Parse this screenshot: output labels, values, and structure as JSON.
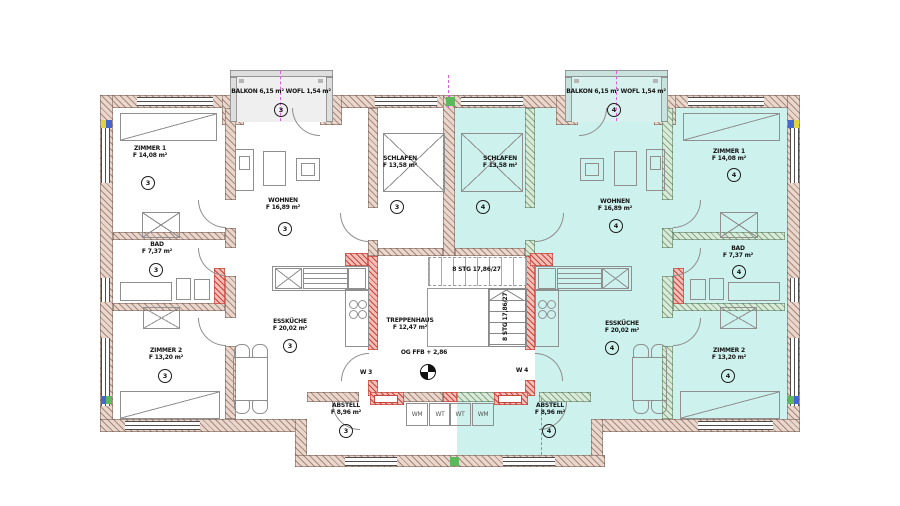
{
  "drawing": {
    "type": "floor-plan",
    "level_label": "OG FFB + 2,86",
    "stair_flight_label": "8 STG 17,86/27",
    "stairwell": {
      "name": "TREPPENHAUS",
      "area": "F 12,47 m²"
    },
    "apartment_left": {
      "number": "3",
      "door_label": "W 3",
      "balcony_label": "BALKON 6,15 m²  WOFL 1,54 m²",
      "rooms": {
        "zimmer1": {
          "name": "ZIMMER 1",
          "area": "F 14,08 m²"
        },
        "schlafen": {
          "name": "SCHLAFEN",
          "area": "F 13,58 m²"
        },
        "wohnen": {
          "name": "WOHNEN",
          "area": "F 16,89 m²"
        },
        "bad": {
          "name": "BAD",
          "area": "F 7,37 m²"
        },
        "zimmer2": {
          "name": "ZIMMER 2",
          "area": "F 13,20 m²"
        },
        "esskueche": {
          "name": "ESSKÜCHE",
          "area": "F 20,02 m²"
        },
        "abstell": {
          "name": "ABSTELL",
          "area": "F 8,96 m²"
        }
      },
      "appliances": [
        "WM",
        "WT"
      ]
    },
    "apartment_right": {
      "number": "4",
      "door_label": "W 4",
      "balcony_label": "BALKON 6,15 m²  WOFL 1,54 m²",
      "rooms": {
        "zimmer1": {
          "name": "ZIMMER 1",
          "area": "F 14,08 m²"
        },
        "schlafen": {
          "name": "SCHLAFEN",
          "area": "F 13,58 m²"
        },
        "wohnen": {
          "name": "WOHNEN",
          "area": "F 16,89 m²"
        },
        "bad": {
          "name": "BAD",
          "area": "F 7,37 m²"
        },
        "zimmer2": {
          "name": "ZIMMER 2",
          "area": "F 13,20 m²"
        },
        "esskueche": {
          "name": "ESSKÜCHE",
          "area": "F 20,02 m²"
        },
        "abstell": {
          "name": "ABSTELL",
          "area": "F 8,96 m²"
        }
      },
      "appliances": [
        "WT",
        "WM"
      ]
    },
    "colors": {
      "unit_fill": "#cdf1ed",
      "balcony_left_fill": "#efefef",
      "balcony_right_fill": "#d7f2ee",
      "balcony_left_wall": "#dedede",
      "balcony_right_wall": "#c9e2de",
      "wall_fill": "#e9d7cd",
      "wall_hatch": "#a8887a",
      "wall2_fill": "#d9ead9",
      "wall2_hatch": "#85a886",
      "new_fill": "#f6beb6",
      "new_hatch": "#c5473d",
      "axis": "#d863d8",
      "marker_yellow": "#ded53e",
      "marker_blue": "#4666cf",
      "marker_green": "#5cb85c",
      "line": "#8f8f8f",
      "text": "#141414"
    }
  }
}
